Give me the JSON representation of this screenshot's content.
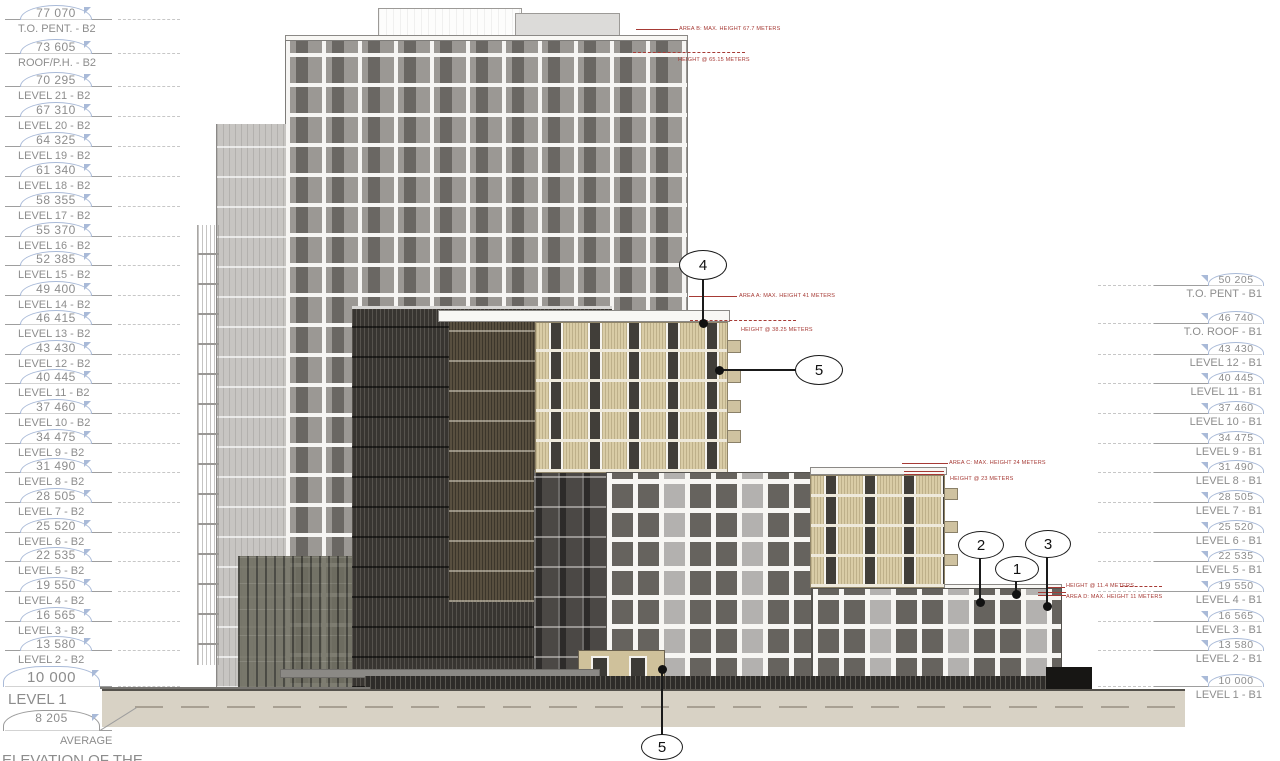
{
  "drawing": {
    "type": "architectural-elevation",
    "footnote": {
      "label_top": "AVERAGE",
      "label_bottom": "ELEVATION OF THE"
    },
    "colors": {
      "annotation_red": "#a63a35",
      "marker_blue": "#a9bad8",
      "marker_text": "#8d8d8d",
      "tower_gray": "#9b9894",
      "dark_facade": "#383531",
      "wood_beige": "#d9cca6",
      "ground_beige": "#d8d2c5"
    },
    "levels": {
      "left": [
        {
          "value": "77 070",
          "label": "T.O. PENT. - B2",
          "y": 20
        },
        {
          "value": "73 605",
          "label": "ROOF/P.H. - B2",
          "y": 54
        },
        {
          "value": "70 295",
          "label": "LEVEL 21 - B2",
          "y": 87
        },
        {
          "value": "67 310",
          "label": "LEVEL 20 - B2",
          "y": 117
        },
        {
          "value": "64 325",
          "label": "LEVEL 19 - B2",
          "y": 147
        },
        {
          "value": "61 340",
          "label": "LEVEL 18 - B2",
          "y": 177
        },
        {
          "value": "58 355",
          "label": "LEVEL 17 - B2",
          "y": 207
        },
        {
          "value": "55 370",
          "label": "LEVEL 16 - B2",
          "y": 237
        },
        {
          "value": "52 385",
          "label": "LEVEL 15 - B2",
          "y": 266
        },
        {
          "value": "49 400",
          "label": "LEVEL 14 - B2",
          "y": 296
        },
        {
          "value": "46 415",
          "label": "LEVEL 13 - B2",
          "y": 325
        },
        {
          "value": "43 430",
          "label": "LEVEL 12 - B2",
          "y": 355
        },
        {
          "value": "40 445",
          "label": "LEVEL 11 - B2",
          "y": 384
        },
        {
          "value": "37 460",
          "label": "LEVEL 10 - B2",
          "y": 414
        },
        {
          "value": "34 475",
          "label": "LEVEL 9 - B2",
          "y": 444
        },
        {
          "value": "31 490",
          "label": "LEVEL 8 - B2",
          "y": 473
        },
        {
          "value": "28 505",
          "label": "LEVEL 7 - B2",
          "y": 503
        },
        {
          "value": "25 520",
          "label": "LEVEL 6 - B2",
          "y": 533
        },
        {
          "value": "22 535",
          "label": "LEVEL 5 - B2",
          "y": 562
        },
        {
          "value": "19 550",
          "label": "LEVEL 4 - B2",
          "y": 592
        },
        {
          "value": "16 565",
          "label": "LEVEL 3 - B2",
          "y": 622
        },
        {
          "value": "13 580",
          "label": "LEVEL 2 - B2",
          "y": 651
        },
        {
          "value": "10 000",
          "label": "LEVEL 1",
          "y": 687,
          "variant": "lg"
        },
        {
          "value": "8 205",
          "label": "AVERAGE",
          "y": 731,
          "variant": "grade"
        }
      ],
      "right": [
        {
          "value": "50 205",
          "label": "T.O. PENT - B1",
          "y": 286
        },
        {
          "value": "46 740",
          "label": "T.O. ROOF - B1",
          "y": 324
        },
        {
          "value": "43 430",
          "label": "LEVEL 12 - B1",
          "y": 355
        },
        {
          "value": "40 445",
          "label": "LEVEL 11 - B1",
          "y": 384
        },
        {
          "value": "37 460",
          "label": "LEVEL 10 - B1",
          "y": 414
        },
        {
          "value": "34 475",
          "label": "LEVEL 9 - B1",
          "y": 444
        },
        {
          "value": "31 490",
          "label": "LEVEL 8 - B1",
          "y": 473
        },
        {
          "value": "28 505",
          "label": "LEVEL 7 - B1",
          "y": 503
        },
        {
          "value": "25 520",
          "label": "LEVEL 6 - B1",
          "y": 533
        },
        {
          "value": "22 535",
          "label": "LEVEL 5 - B1",
          "y": 562
        },
        {
          "value": "19 550",
          "label": "LEVEL 4 - B1",
          "y": 592
        },
        {
          "value": "16 565",
          "label": "LEVEL 3 - B1",
          "y": 622
        },
        {
          "value": "13 580",
          "label": "LEVEL 2 - B1",
          "y": 651
        },
        {
          "value": "10 000",
          "label": "LEVEL 1 - B1",
          "y": 687
        }
      ]
    },
    "annotations": {
      "area_b_max": "AREA B: MAX. HEIGHT 67.7 METERS",
      "area_b_at": "HEIGHT @ 65.15 METERS",
      "area_a_max": "AREA A: MAX. HEIGHT 41 METERS",
      "area_a_at": "HEIGHT @ 38.25 METERS",
      "area_c_max": "AREA C: MAX. HEIGHT 24 METERS",
      "area_c_at": "HEIGHT @ 23 METERS",
      "area_d_at": "HEIGHT @ 11.4 METERS",
      "area_d_max": "AREA D: MAX. HEIGHT 11 METERS"
    },
    "callouts": [
      {
        "num": "4",
        "cx": 703,
        "cy": 265,
        "rx": 24,
        "ry": 15,
        "dx": 703,
        "dy": 323,
        "o": "v"
      },
      {
        "num": "5",
        "cx": 819,
        "cy": 370,
        "rx": 24,
        "ry": 15,
        "dx": 719,
        "dy": 370,
        "o": "h"
      },
      {
        "num": "2",
        "cx": 981,
        "cy": 545,
        "rx": 23,
        "ry": 14,
        "dx": 980,
        "dy": 602,
        "o": "v"
      },
      {
        "num": "1",
        "cx": 1017,
        "cy": 569,
        "rx": 22,
        "ry": 13,
        "dx": 1016,
        "dy": 594,
        "o": "v"
      },
      {
        "num": "3",
        "cx": 1048,
        "cy": 544,
        "rx": 23,
        "ry": 14,
        "dx": 1047,
        "dy": 606,
        "o": "v"
      },
      {
        "num": "5",
        "cx": 662,
        "cy": 747,
        "rx": 21,
        "ry": 13,
        "dx": 662,
        "dy": 669,
        "o": "v"
      }
    ]
  }
}
